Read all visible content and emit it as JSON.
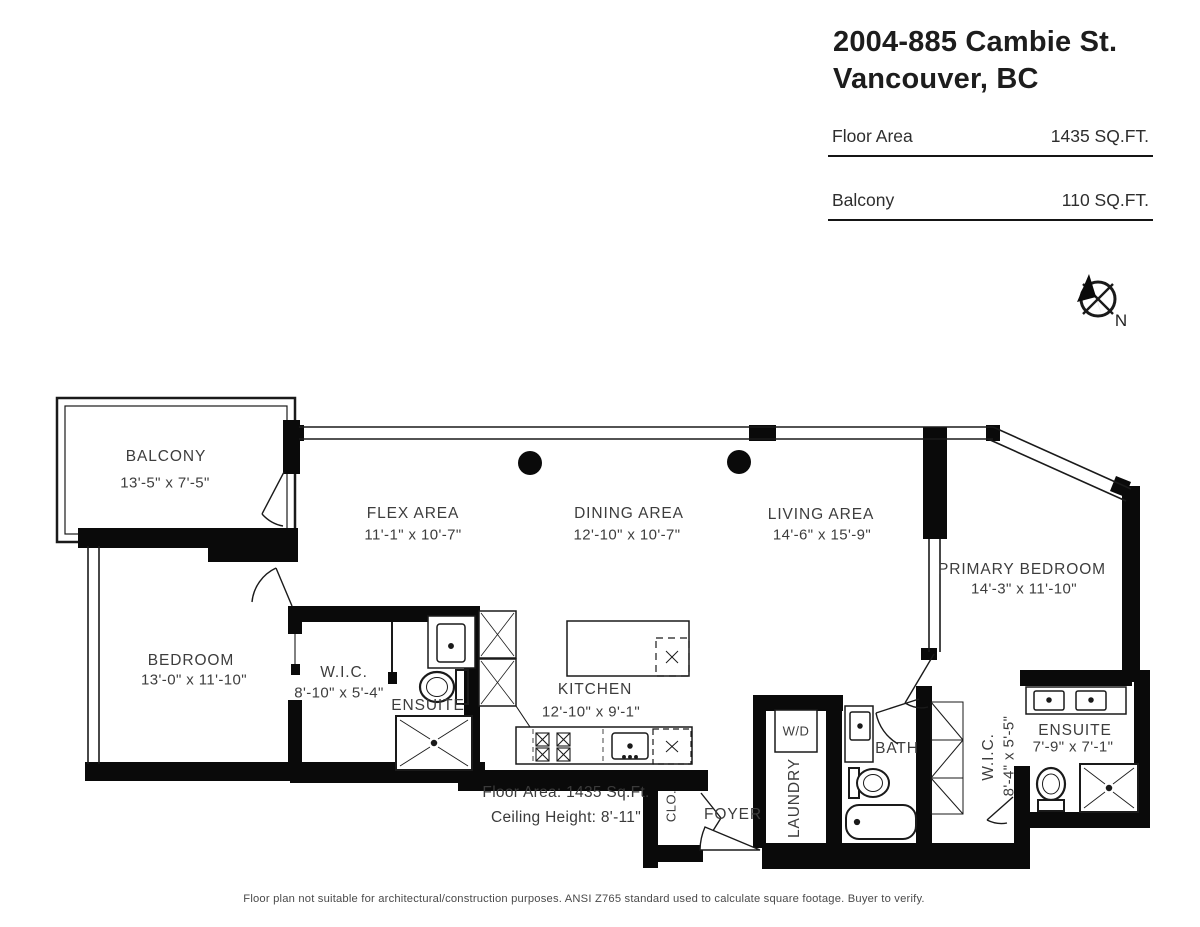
{
  "header": {
    "address_line1": "2004-885 Cambie St.",
    "address_line2": "Vancouver, BC",
    "stats": [
      {
        "label": "Floor Area",
        "value": "1435 SQ.FT."
      },
      {
        "label": "Balcony",
        "value": "110 SQ.FT."
      }
    ]
  },
  "compass": {
    "north_label": "N"
  },
  "rooms": {
    "balcony": {
      "name": "BALCONY",
      "dims": "13'-5\" x 7'-5\""
    },
    "flex": {
      "name": "FLEX AREA",
      "dims": "11'-1\" x 10'-7\""
    },
    "dining": {
      "name": "DINING AREA",
      "dims": "12'-10\" x 10'-7\""
    },
    "living": {
      "name": "LIVING AREA",
      "dims": "14'-6\" x 15'-9\""
    },
    "primary_bedroom": {
      "name": "PRIMARY BEDROOM",
      "dims": "14'-3\" x 11'-10\""
    },
    "bedroom": {
      "name": "BEDROOM",
      "dims": "13'-0\" x 11'-10\""
    },
    "wic1": {
      "name": "W.I.C.",
      "dims": "8'-10\" x 5'-4\""
    },
    "ensuite1": {
      "name": "ENSUITE"
    },
    "kitchen": {
      "name": "KITCHEN",
      "dims": "12'-10\" x 9'-1\""
    },
    "closet": {
      "name": "CLO."
    },
    "foyer": {
      "name": "FOYER"
    },
    "laundry": {
      "name": "LAUNDRY"
    },
    "bath": {
      "name": "BATH"
    },
    "wic2": {
      "name": "W.I.C.",
      "dims": "8'-4\" x 5'-5\""
    },
    "ensuite2": {
      "name": "ENSUITE",
      "dims": "7'-9\" x 7'-1\""
    }
  },
  "fixtures": {
    "washer_dryer": "W/D"
  },
  "notes": {
    "floor_area": "Floor Area: 1435 Sq.Ft.",
    "ceiling_height": "Ceiling Height: 8'-11\"",
    "disclaimer": "Floor plan not suitable for architectural/construction purposes. ANSI Z765 standard used to calculate square footage. Buyer to verify."
  },
  "colors": {
    "wall": "#0a0a0a",
    "line": "#1a1a1a",
    "label_text": "#3d3d3d",
    "background": "#ffffff"
  }
}
